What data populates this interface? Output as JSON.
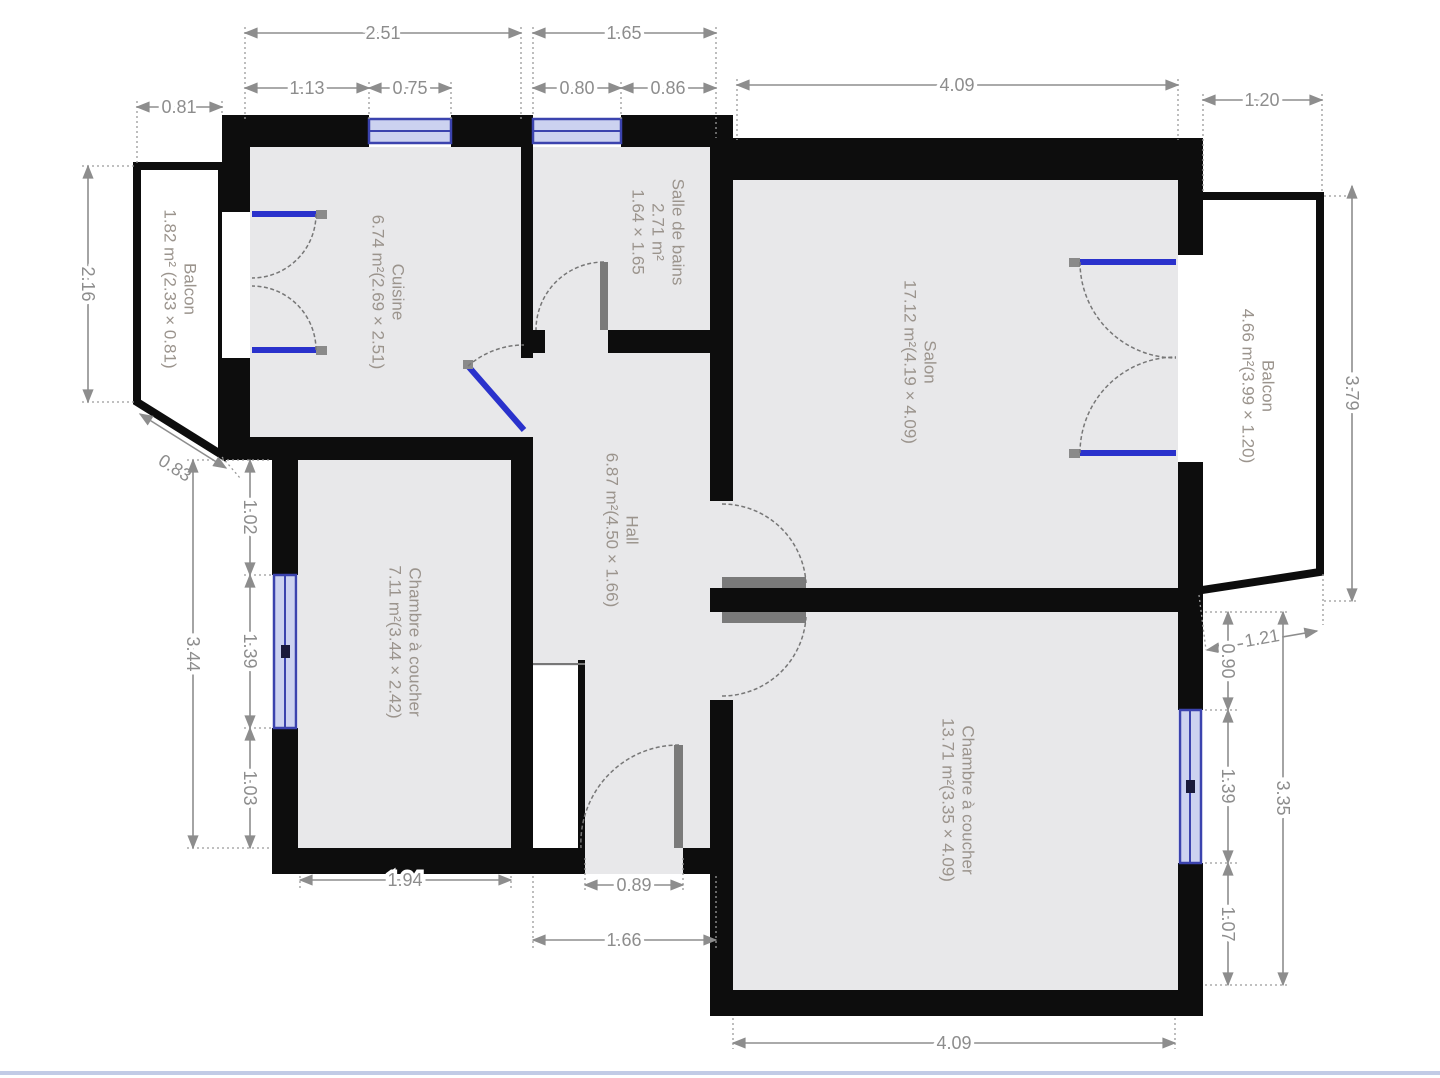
{
  "plan": {
    "rooms": [
      {
        "id": "cuisine",
        "name": "Cuisine",
        "detail": "6.74 m²(2.69 × 2.51)"
      },
      {
        "id": "salle-de-bains",
        "name": "Salle de bains",
        "detail": "2.71 m²",
        "detail2": "1.64 × 1.65"
      },
      {
        "id": "salon",
        "name": "Salon",
        "detail": "17.12 m²(4.19 × 4.09)"
      },
      {
        "id": "balcon-droit",
        "name": "Balcon",
        "detail": "4.66 m²(3.99 × 1.20)"
      },
      {
        "id": "balcon-gauche",
        "name": "Balcon",
        "detail": "1.82 m² (2.33 × 0.81)"
      },
      {
        "id": "hall",
        "name": "Hall",
        "detail": "6.87 m²(4.50 × 1.66)"
      },
      {
        "id": "chambre-a-coucher-1",
        "name": "Chambre à coucher",
        "detail": "7.11 m²(3.44 × 2.42)"
      },
      {
        "id": "chambre-a-coucher-2",
        "name": "Chambre à coucher",
        "detail": "13.71 m²(3.35 × 4.09)"
      }
    ],
    "dims": {
      "top": {
        "d251": "2.51",
        "d165": "1.65",
        "d113": "1.13",
        "d075": "0.75",
        "d080": "0.80",
        "d086": "0.86",
        "d409": "4.09",
        "d120": "1.20",
        "d081": "0.81"
      },
      "left": {
        "d216": "2.16",
        "d083": "0.83",
        "d102": "1.02",
        "d139": "1.39",
        "d103": "1.03",
        "d344": "3.44"
      },
      "right": {
        "d379": "3.79",
        "d121": "1.21",
        "d090": "0.90",
        "d139": "1.39",
        "d335": "3.35",
        "d107": "1.07"
      },
      "bottom": {
        "d194": "1.94",
        "d089": "0.89",
        "d166": "1.66",
        "d409": "4.09"
      }
    }
  },
  "colors": {
    "wall": "#0d0d0d",
    "room_fill": "#e8e8ea",
    "balcony_fill": "#ffffff",
    "window_blue": "#3b43ae",
    "window_light": "#ccd2f0",
    "door_blue": "#2a32cc",
    "door_gray": "#7a7a7a",
    "dim_gray": "#8d8d8d",
    "label_gray": "#9b948d",
    "viewer_line": "#c2cbe6"
  }
}
